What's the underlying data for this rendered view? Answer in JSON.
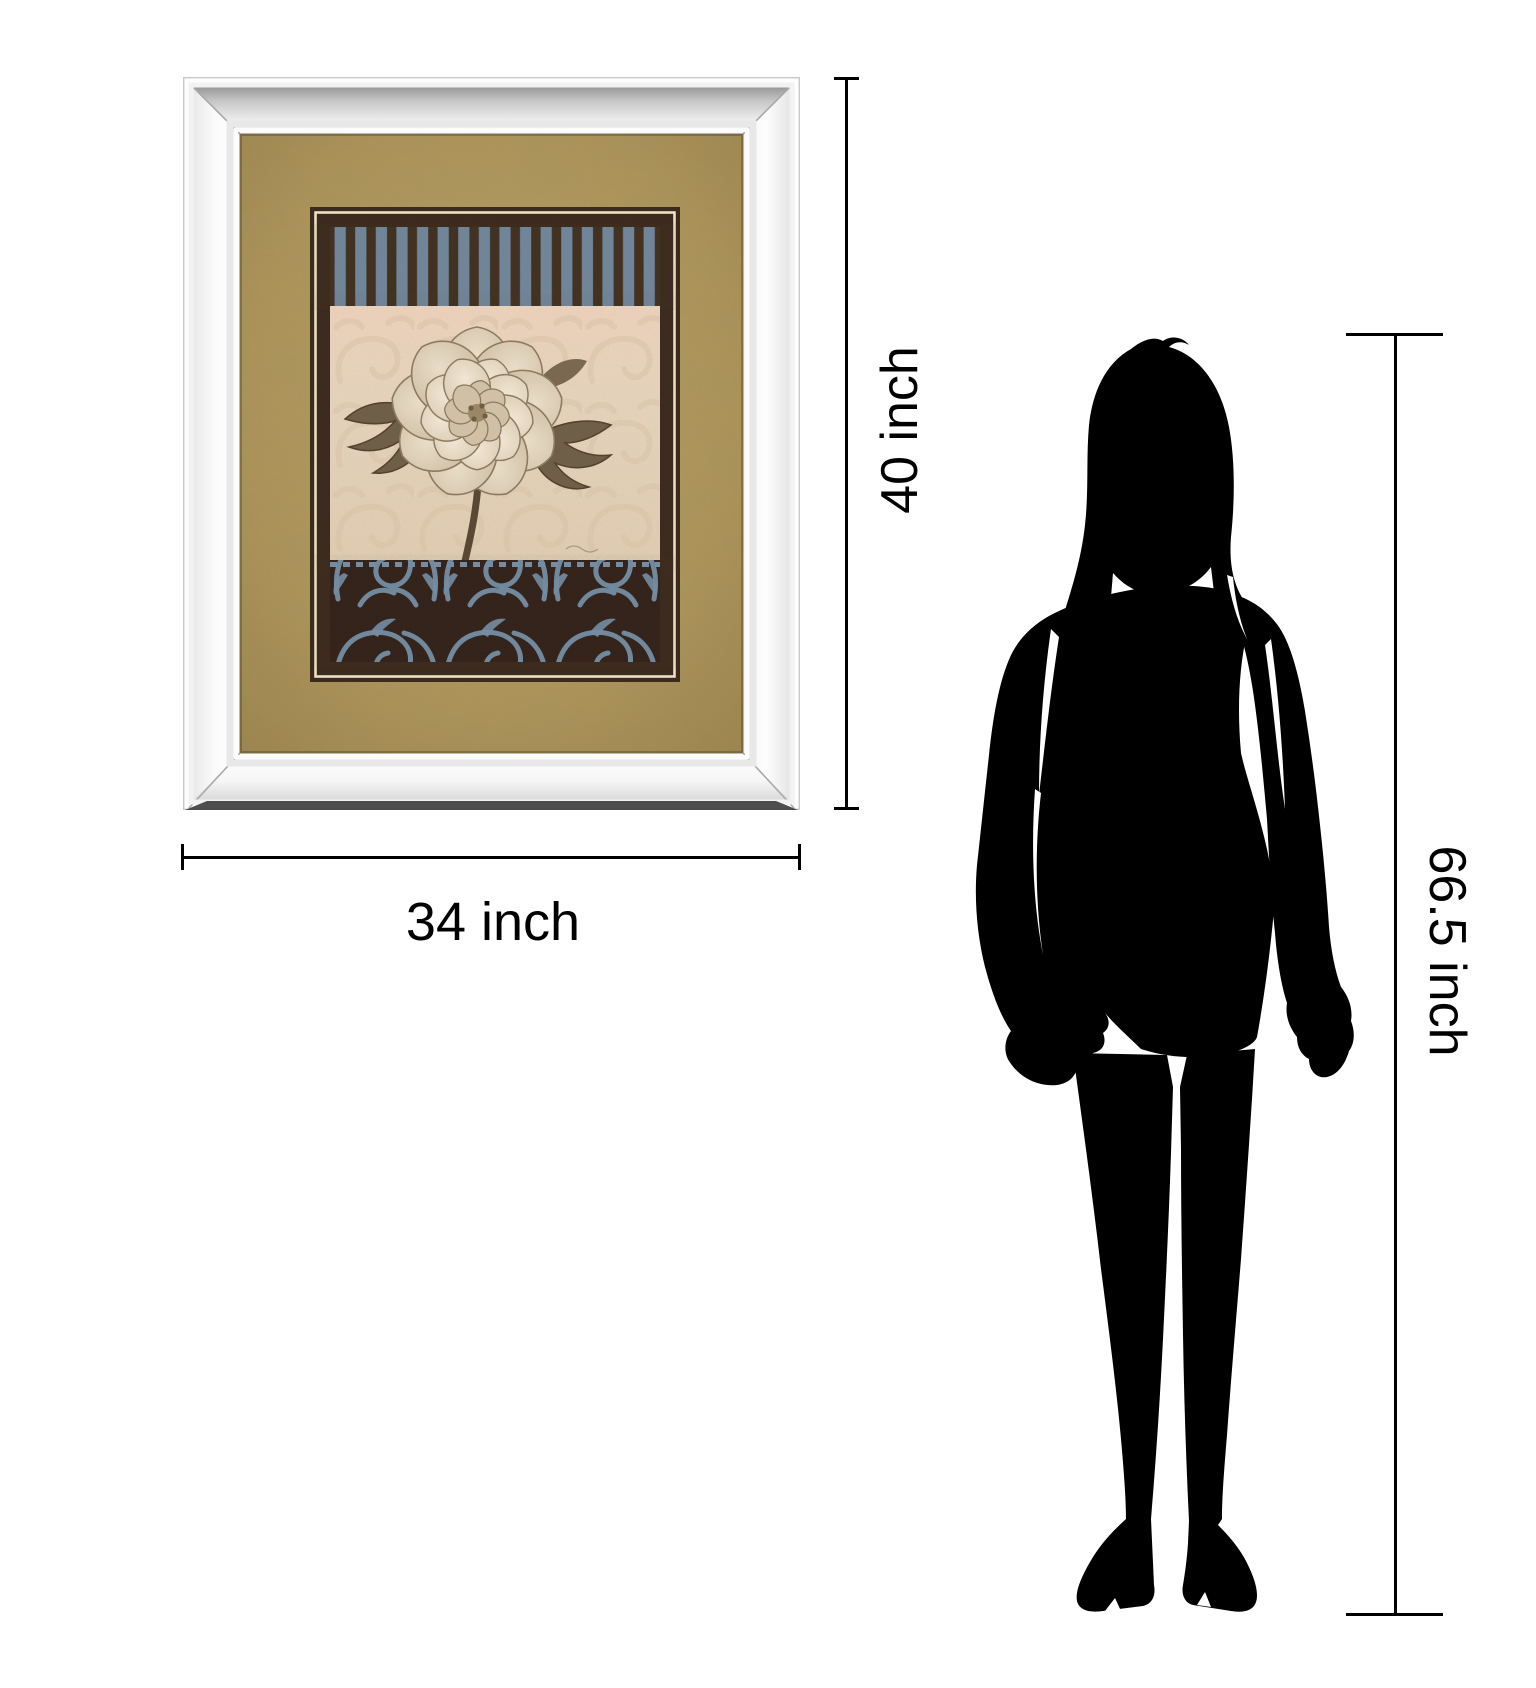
{
  "page": {
    "background_color": "#ffffff",
    "figure_type": "product size comparison illustration"
  },
  "dimensions": {
    "artwork_height": {
      "label": "40 inch"
    },
    "artwork_width": {
      "label": "34 inch"
    },
    "person_height": {
      "label": "66.5 inch"
    },
    "line_color": "#000000",
    "label_color": "#000000"
  },
  "artwork": {
    "type": "mirror-framed floral art print",
    "colors": {
      "frame_face": "#f3f3f3",
      "frame_bevel_dark": "#8a8a8a",
      "frame_bottom_shadow": "#3f3f3f",
      "mat_gold": "#af9659",
      "border_brown": "#3b2a1d",
      "pinstripe_cream": "#ebe1c7",
      "stripe_blue": "#71889e",
      "stripe_brown": "#41301f",
      "damask_background": "#e7d4bd",
      "damask_motif": "#d9c3a7",
      "flower_petal": "#cdbda3",
      "leaf": "#6f5e48",
      "scroll_blue": "#7590a9",
      "scroll_band_brown": "#33221a"
    }
  },
  "person": {
    "silhouette_color": "#000000",
    "description": "standing woman silhouette"
  }
}
